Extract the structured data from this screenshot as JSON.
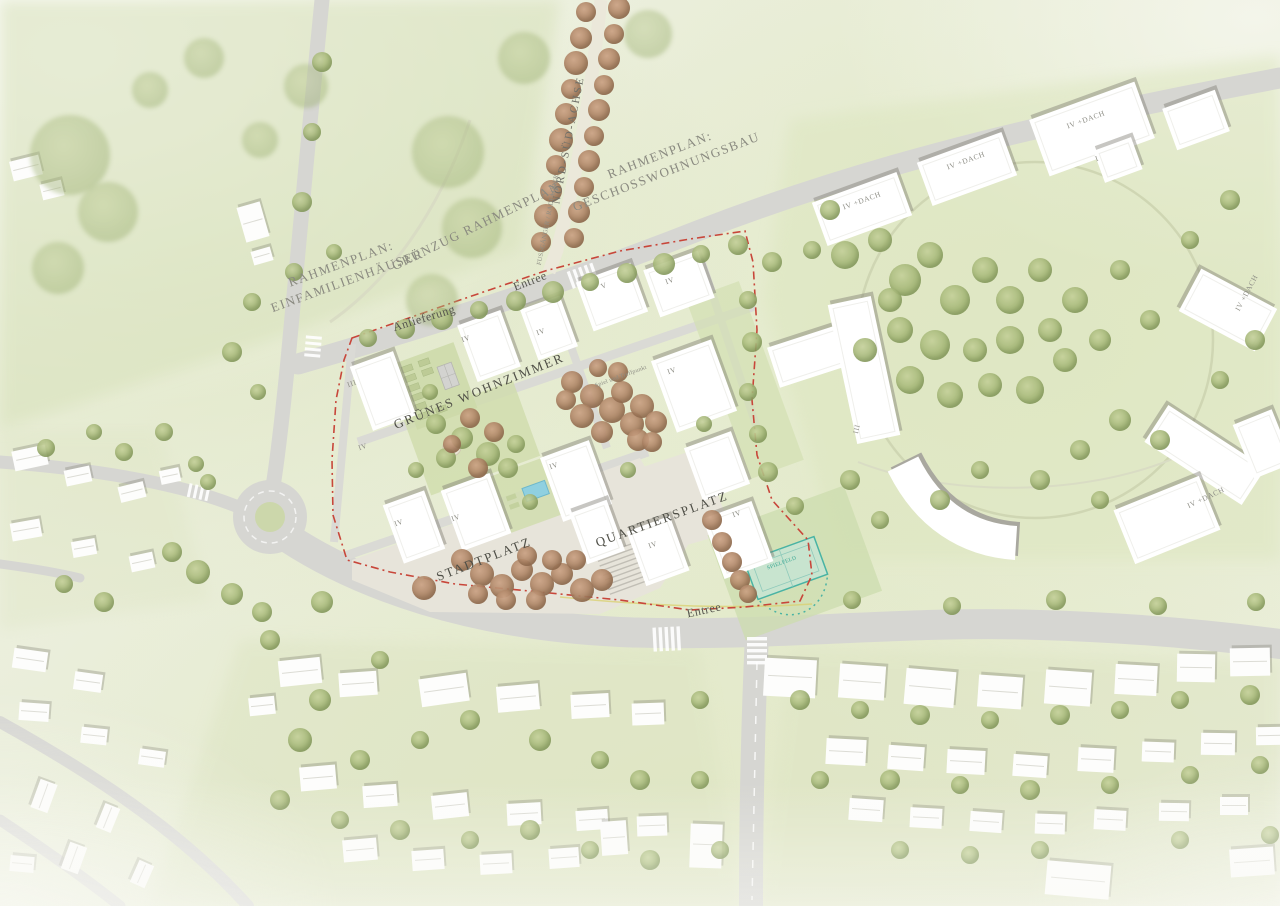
{
  "map": {
    "area_labels": {
      "rahmenplan_einfamilienhaeuser": "RAHMENPLAN:\nEINFAMILIENHÄUSER",
      "gruenzug_rahmenplan": "GRÜNZUG RAHMENPLAN",
      "fussgaenger_radfahrer": "FUSSGÄNGER / RADFAHRER",
      "nord_sued_achse": "NORD-SÜD-ACHSE",
      "rahmenplan_geschosswohnungsbau": "RAHMENPLAN:\nGESCHOSSWOHNUNGSBAU",
      "entree_nord": "Entree",
      "anlieferung": "Anlieferung",
      "gruenes_wohnzimmer": "GRÜNES WOHNZIMMER",
      "spiel_und_treffpunkt": "Spiel und Treffpunkt",
      "quartiersplatz": "QUARTIERSPLATZ",
      "stadtplatz": "STADTPLATZ",
      "entree_sued": "Entree",
      "spielfeld": "SPIELFELD"
    },
    "building_labels": {
      "iv_dach": "IV +DACH",
      "iv": "IV",
      "v": "V",
      "iii": "III",
      "one": "I"
    },
    "colors": {
      "boundary_red": "#c8463a",
      "water_teal": "#49b3a4",
      "tree_green": "#9fb271",
      "tree_russet": "#a87f60",
      "road_gray": "#d6d6d2",
      "building_white": "#ffffff"
    }
  }
}
